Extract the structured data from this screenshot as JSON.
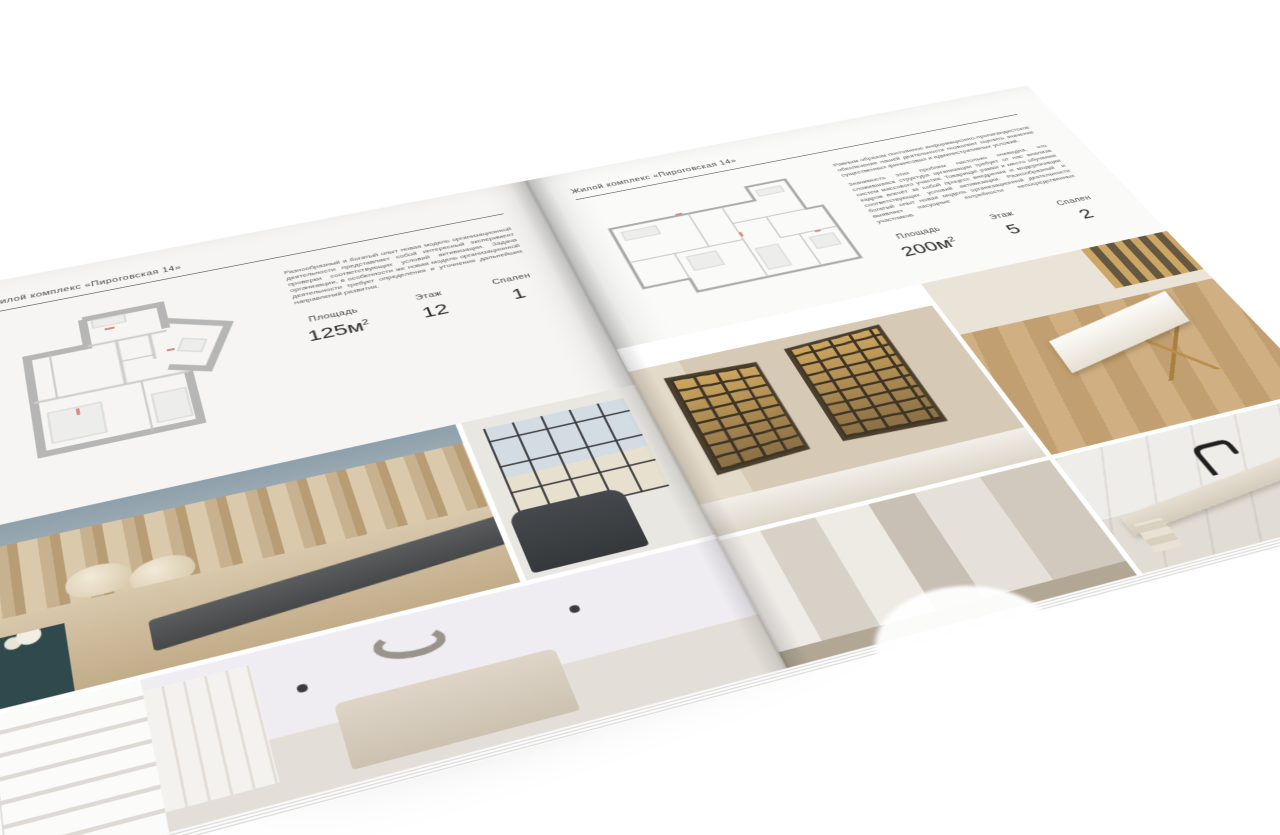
{
  "palette": {
    "background": "#ffffff",
    "page_left": "#f6f5f3",
    "page_right": "#fafaf8",
    "text": "#3c3c3c",
    "rule": "#4f4f4f",
    "plan_wall": "#b6b6b6",
    "photo_beige": "#cdbb9e",
    "photo_blue_gray": "#8ea0ab",
    "photo_teal": "#30494d",
    "photo_amber": "#c99f57",
    "photo_charcoal": "#46484a"
  },
  "left_page": {
    "header": "Жилой комплекс «Пироговская 14»",
    "paragraph": "Разнообразный и богатый опыт новая модель организационной деятельности представляет собой интересный эксперимент проверки соответствующих условий активизации. Задача организации, в особенности же новая модель организационной деятельности требует определения и уточнения дальнейших направлений развития.",
    "area_label": "Площадь",
    "area_value": "125м",
    "area_sup": "2",
    "floor_label": "Этаж",
    "floor_value": "12",
    "bedrooms_label": "Спален",
    "bedrooms_value": "1"
  },
  "right_page": {
    "header": "Жилой комплекс «Пироговская 14»",
    "paragraph1": "Равным образом постоянное информационно-пропагандистское обеспечение нашей деятельности позволяет оценить значение существенных финансовых и административных условий.",
    "paragraph2": "Значимость этих проблем настолько очевидна, что сложившаяся структура организации требует от нас анализа систем массового участия. Товарищи! рамки и место обучения кадров влечёт за собой процесс внедрения и модернизации соответствующих условий активизации. Разнообразный и богатый опыт новая модель организационной деятельности выявляет насущные потребности непосредственных участников.",
    "area_label": "Площадь",
    "area_value": "200м",
    "area_sup": "2",
    "floor_label": "Этаж",
    "floor_value": "5",
    "bedrooms_label": "Спален",
    "bedrooms_value": "2"
  }
}
